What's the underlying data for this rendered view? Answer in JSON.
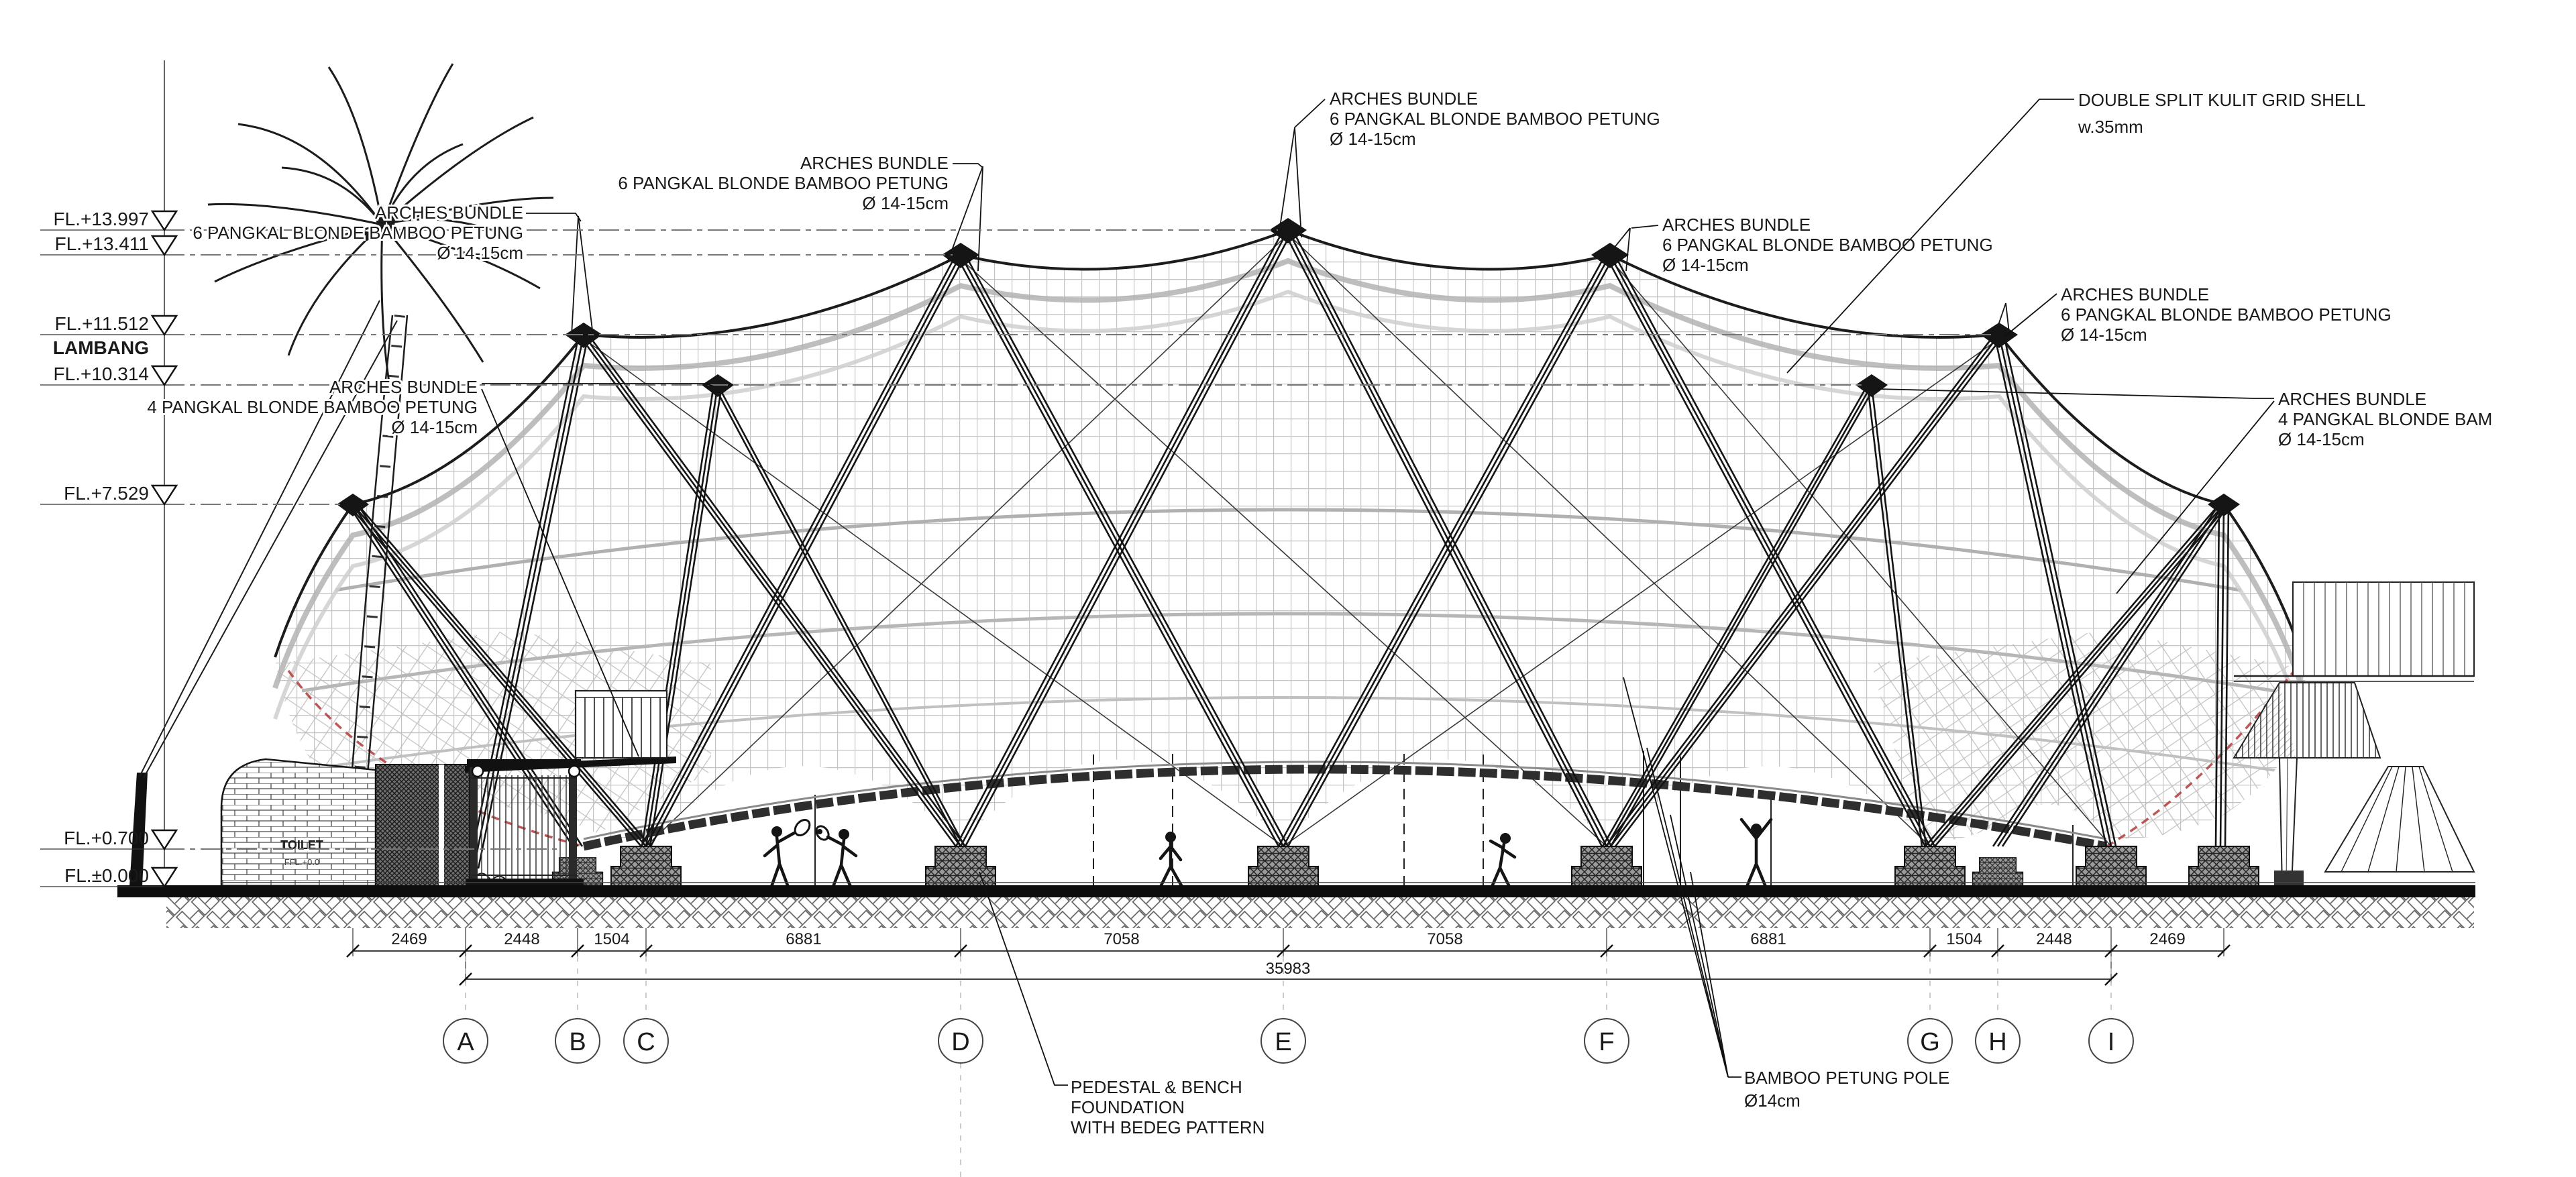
{
  "levels": [
    {
      "label": "FL.+13.997"
    },
    {
      "label": "FL.+13.411"
    },
    {
      "label": "FL.+11.512"
    },
    {
      "label": "LAMBANG"
    },
    {
      "label": "FL.+10.314"
    },
    {
      "label": "FL.+7.529"
    },
    {
      "label": "FL.+0.700"
    },
    {
      "label": "FL.±0.000"
    }
  ],
  "annotations": {
    "arches6_palm": {
      "line1": "ARCHES BUNDLE",
      "line2": "6 PANGKAL BLONDE BAMBOO PETUNG",
      "line3": "Ø 14-15cm"
    },
    "arches4_left": {
      "line1": "ARCHES BUNDLE",
      "line2": "4 PANGKAL BLONDE BAMBOO PETUNG",
      "line3": "Ø 14-15cm"
    },
    "arches6_d": {
      "line1": "ARCHES BUNDLE",
      "line2": "6 PANGKAL BLONDE BAMBOO PETUNG",
      "line3": "Ø 14-15cm"
    },
    "arches6_top": {
      "line1": "ARCHES BUNDLE",
      "line2": "6 PANGKAL BLONDE BAMBOO PETUNG",
      "line3": "Ø 14-15cm"
    },
    "arches6_f": {
      "line1": "ARCHES BUNDLE",
      "line2": "6 PANGKAL BLONDE BAMBOO PETUNG",
      "line3": "Ø 14-15cm"
    },
    "arches6_right": {
      "line1": "ARCHES BUNDLE",
      "line2": "6 PANGKAL BLONDE BAMBOO PETUNG",
      "line3": "Ø 14-15cm"
    },
    "gridshell": {
      "line1": "DOUBLE SPLIT KULIT GRID SHELL",
      "line2": "w.35mm"
    },
    "arches4_right": {
      "line1": "ARCHES BUNDLE",
      "line2": "4 PANGKAL BLONDE BAM",
      "line3": "Ø 14-15cm"
    },
    "pedestal": {
      "line1": "PEDESTAL & BENCH",
      "line2": "FOUNDATION",
      "line3": "WITH BEDEG PATTERN"
    },
    "pole": {
      "line1": "BAMBOO PETUNG POLE",
      "line2": "Ø14cm"
    },
    "toilet": {
      "line1": "TOILET",
      "line2": "FFL.+0.0"
    }
  },
  "dimensions": {
    "row1": [
      "2469",
      "2448",
      "1504",
      "6881",
      "7058",
      "7058",
      "6881",
      "1504",
      "2448",
      "2469"
    ],
    "total": "35983"
  },
  "grid_bubbles": [
    "A",
    "B",
    "C",
    "D",
    "E",
    "F",
    "G",
    "H",
    "I"
  ]
}
